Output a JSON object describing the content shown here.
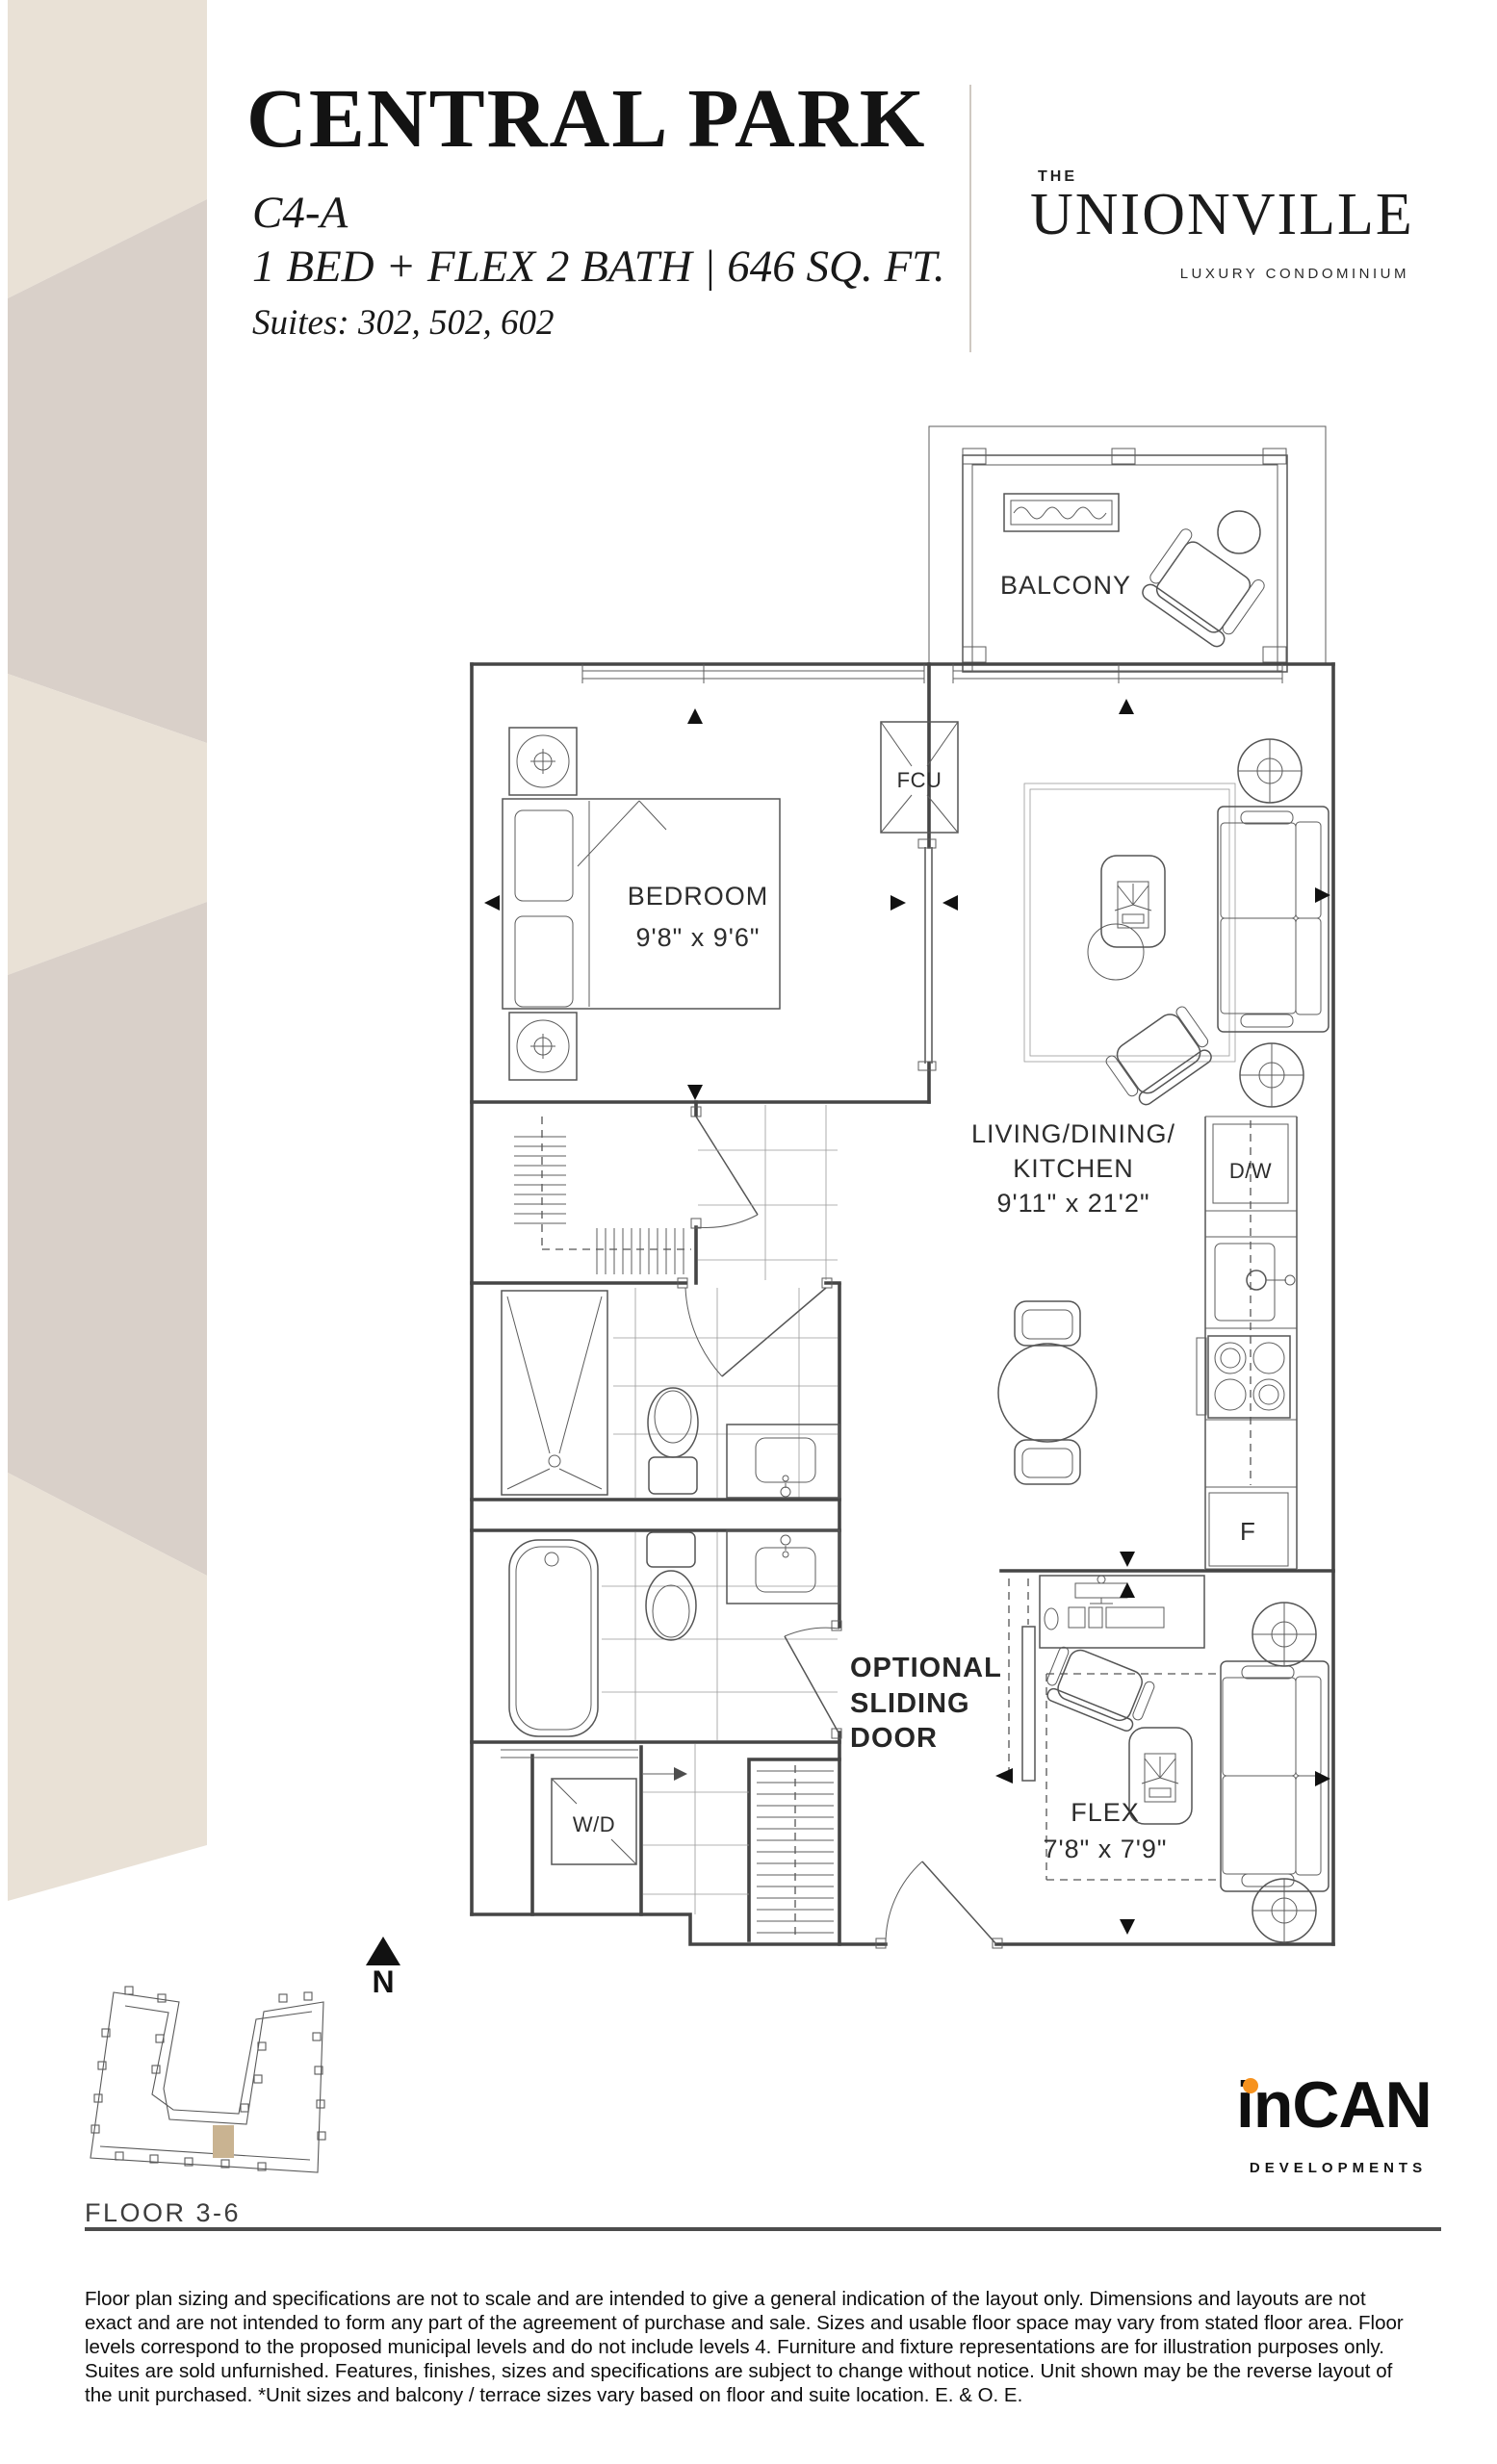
{
  "header": {
    "title": "CENTRAL PARK",
    "unit_code": "C4-A",
    "specs": "1 BED + FLEX 2 BATH  |  646 SQ. FT.",
    "suites": "Suites: 302, 502, 602"
  },
  "brand": {
    "the": "THE",
    "name": "UNIONVILLE",
    "tagline": "LUXURY CONDOMINIUM"
  },
  "plan": {
    "balcony": "BALCONY",
    "fcu": "FCU",
    "bedroom": "BEDROOM",
    "bedroom_dims": "9'8\" x 9'6\"",
    "living_line1": "LIVING/DINING/",
    "living_line2": "KITCHEN",
    "living_dims": "9'11\" x 21'2\"",
    "dw": "D/W",
    "fridge": "F",
    "wd": "W/D",
    "sliding_line1": "OPTIONAL",
    "sliding_line2": "SLIDING",
    "sliding_line3": "DOOR",
    "flex": "FLEX",
    "flex_dims": "7'8\" x 7'9\"",
    "north": "N"
  },
  "keyplan": {
    "floor_label": "FLOOR 3-6"
  },
  "developer": {
    "name": "inCAN",
    "tagline": "DEVELOPMENTS"
  },
  "disclaimer": "Floor plan sizing and specifications are not to scale and are intended to give a general indication of the layout only. Dimensions and layouts are not exact and are not intended to form any part of the agreement of purchase and sale. Sizes and usable floor space may vary from stated floor area. Floor levels correspond to the proposed municipal levels and do not include levels 4. Furniture and fixture representations are for illustration purposes only. Suites are sold unfurnished. Features, finishes, sizes and specifications are subject to change without notice. Unit shown may be the reverse layout of the unit purchased. *Unit sizes and balcony / terrace sizes vary based on floor and suite location. E. & O. E.",
  "colors": {
    "band_cream": "#e9e1d6",
    "band_greige": "#d9d0c9",
    "suite_highlight": "#c9b391",
    "logo_orange": "#f6921e",
    "line_dark": "#454545"
  }
}
